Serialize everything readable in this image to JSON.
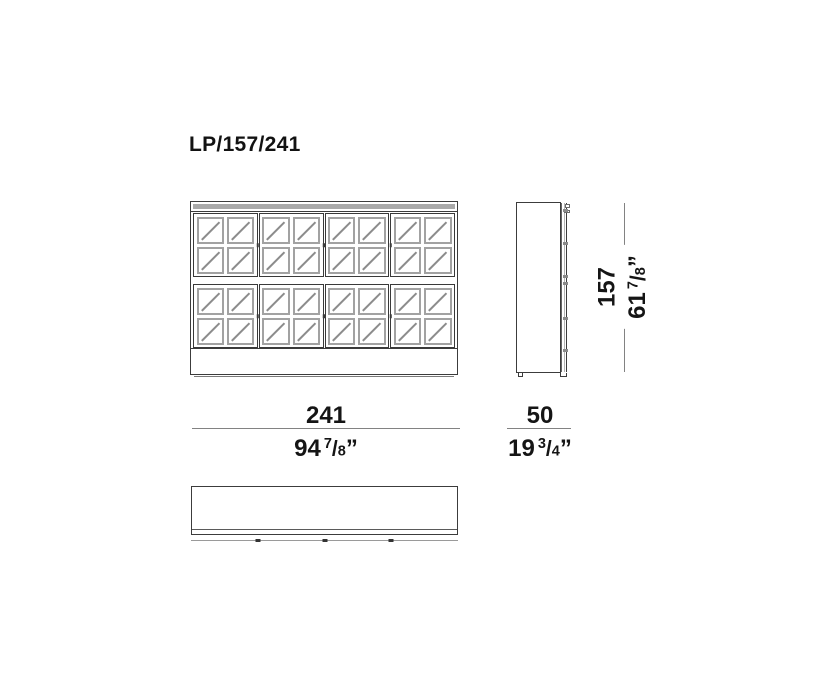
{
  "title": "LP/157/241",
  "drawing": {
    "front_view": {
      "door_columns": 4,
      "door_rows": 2,
      "panes_per_door_x": 2,
      "panes_per_door_y": 2
    },
    "colors": {
      "outline": "#3c3c3c",
      "glazing_bar": "#a2a2a2",
      "glass_mark": "#8c8c8c",
      "dimension_line": "#828282",
      "text": "#151515"
    }
  },
  "dimensions": {
    "width": {
      "metric": "241",
      "imperial_whole": "94",
      "fraction_numerator": "7",
      "fraction_denominator": "8",
      "unit_mark": "”"
    },
    "depth": {
      "metric": "50",
      "imperial_whole": "19",
      "fraction_numerator": "3",
      "fraction_denominator": "4",
      "unit_mark": "”"
    },
    "height": {
      "metric": "157",
      "imperial_whole": "61",
      "fraction_numerator": "7",
      "fraction_denominator": "8",
      "unit_mark": "”"
    }
  }
}
